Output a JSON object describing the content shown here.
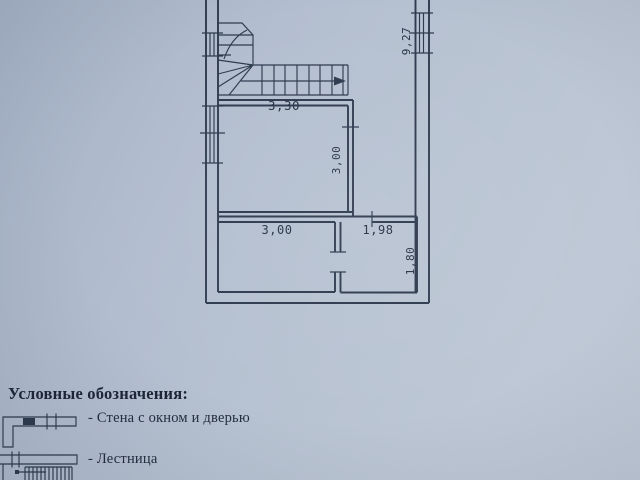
{
  "plan": {
    "dim_stair_flight_width": "3,30",
    "dim_hall_room_height": "3,00",
    "dim_bottom_left_room_width": "3,00",
    "dim_bottom_right_room_width": "1,98",
    "dim_bottom_right_room_height": "1,80",
    "dim_building_side_length": "9,27"
  },
  "legend": {
    "title": "Условные обозначения:",
    "items": [
      {
        "label": "- Стена с окном и дверью"
      },
      {
        "label": "- Лестница"
      }
    ]
  },
  "colors": {
    "ink": "#2e3a4e",
    "paper_dark": "#a6b2c6",
    "paper_light": "#c2cbd8"
  }
}
